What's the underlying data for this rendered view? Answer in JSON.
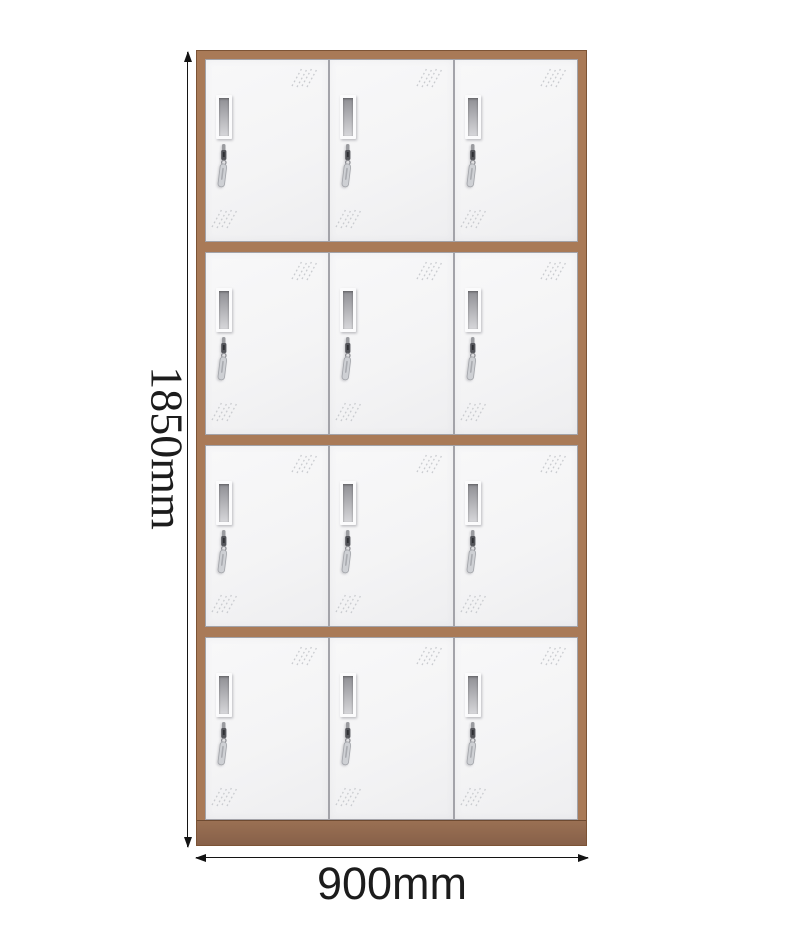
{
  "product": {
    "type": "locker-cabinet",
    "rows": 4,
    "columns": 3,
    "door_count": 12,
    "colors": {
      "frame": "#a97a57",
      "frame_edge": "#7c5335",
      "base": "#9a7053",
      "door": "#f5f5f6",
      "door_edge": "#a3a3a9"
    },
    "door_features": [
      "vent-slot-icon",
      "lock-key-icon",
      "reflection-hatch-icon"
    ]
  },
  "dimensions": {
    "height": {
      "label": "1850mm"
    },
    "width": {
      "label": "900mm"
    },
    "line_color": "#141414",
    "text_color": "#1c1c1c"
  },
  "icons": {
    "arrow_up": "arrow-up-icon",
    "arrow_down": "arrow-down-icon",
    "arrow_left": "arrow-left-icon",
    "arrow_right": "arrow-right-icon",
    "vent": "vent-slot-icon",
    "lock": "lock-key-icon",
    "hatch": "reflection-hatch-icon"
  }
}
